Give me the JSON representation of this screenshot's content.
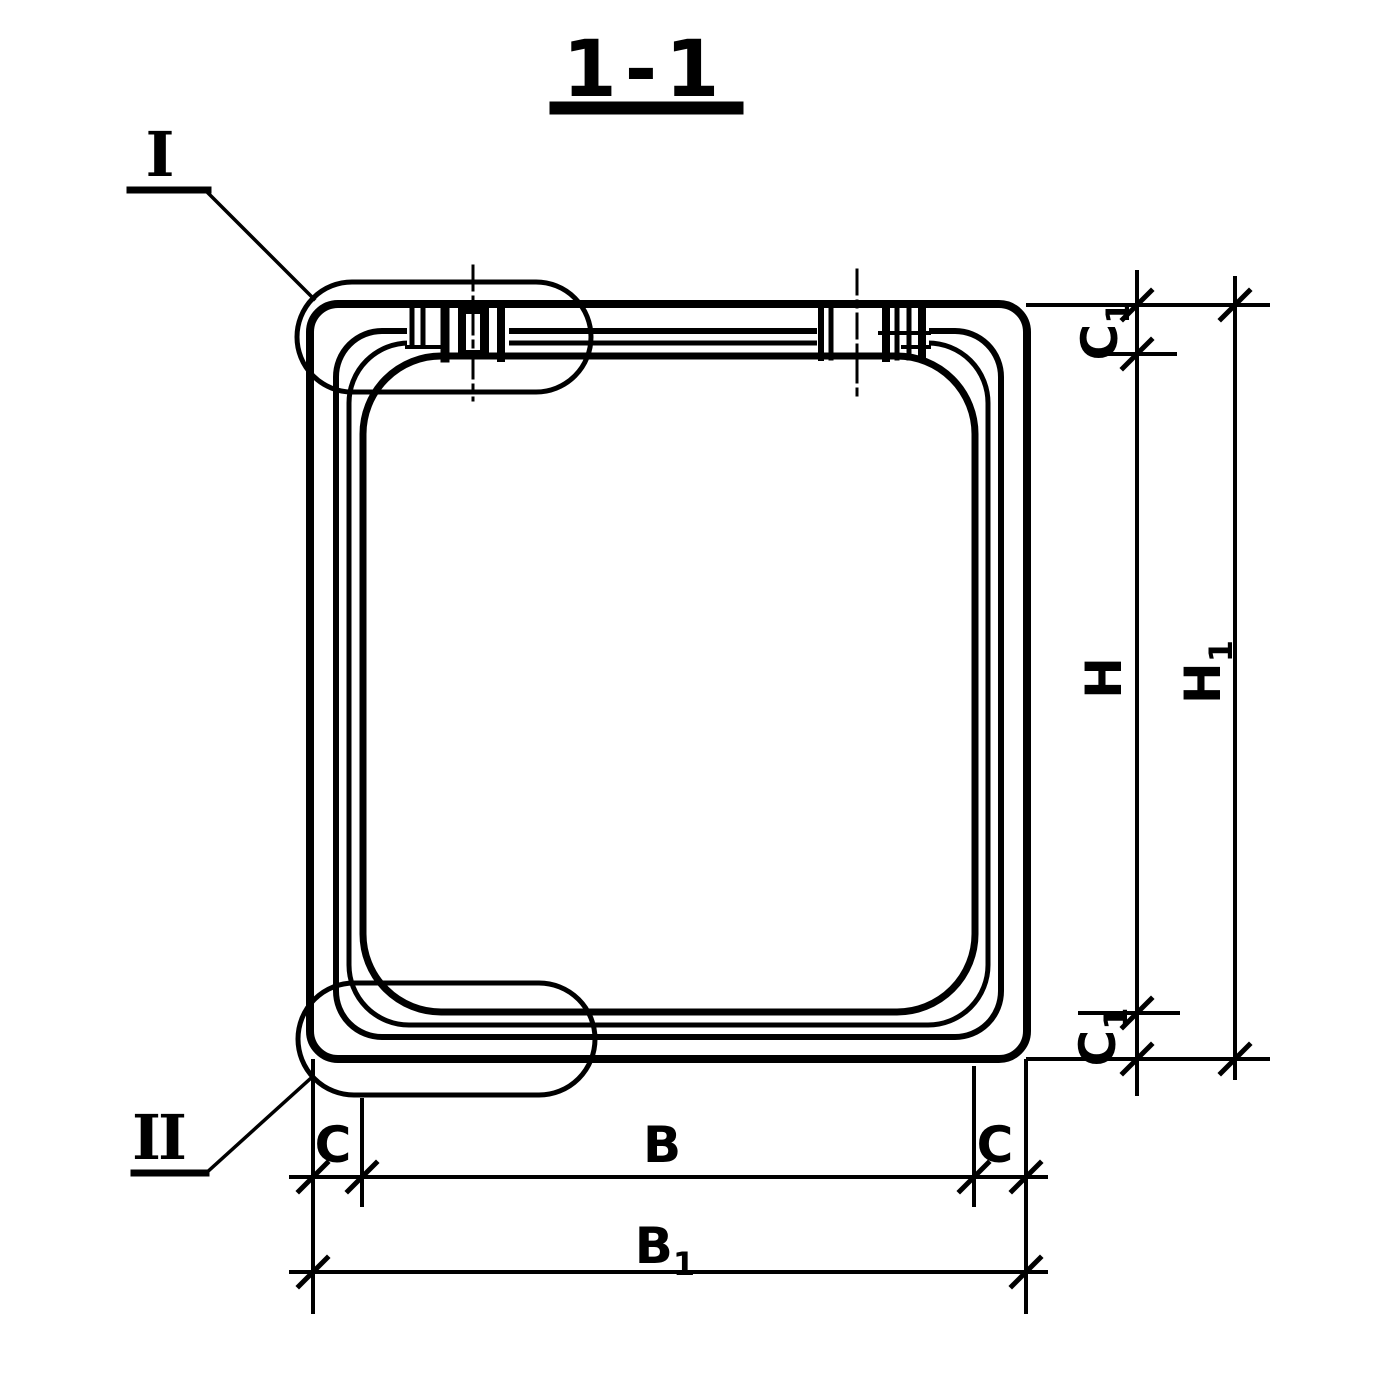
{
  "page": {
    "paper_color": "#ffffff",
    "ink_color": "#000000"
  },
  "title": {
    "label": "1-1"
  },
  "callouts": {
    "detail_top": "I",
    "detail_bottom": "II"
  },
  "dimensions": {
    "c1_top": {
      "text": "C",
      "sub": "1"
    },
    "h": {
      "text": "H",
      "sub": ""
    },
    "h1": {
      "text": "H",
      "sub": "1"
    },
    "c1_bottom": {
      "text": "C",
      "sub": "1"
    },
    "c_left": {
      "text": "C",
      "sub": ""
    },
    "b": {
      "text": "B",
      "sub": ""
    },
    "c_right": {
      "text": "C",
      "sub": ""
    },
    "b1": {
      "text": "B",
      "sub": "1"
    }
  }
}
